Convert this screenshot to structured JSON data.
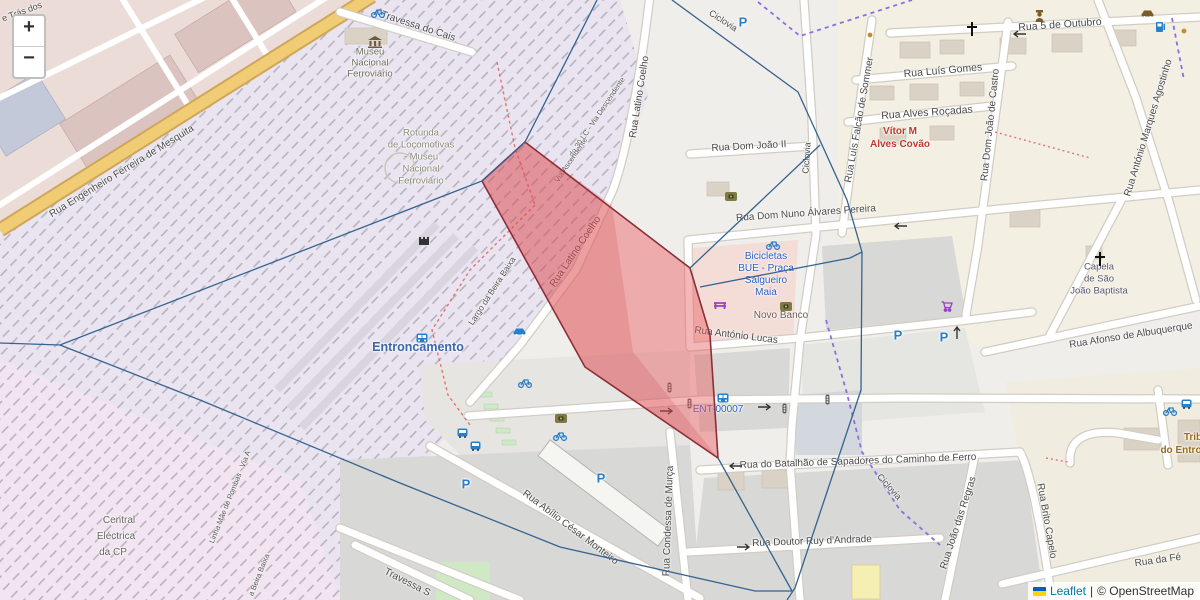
{
  "controls": {
    "zoom_in": "+",
    "zoom_out": "−"
  },
  "attribution": {
    "leaflet": "Leaflet",
    "separator": "|",
    "osm_credit": "© OpenStreetMap"
  },
  "labels": [
    {
      "name": "street-tras-dos",
      "text": "e Trás dos",
      "x": 22,
      "y": 12,
      "rot": -20,
      "size": 9,
      "color": "#4a4a4a"
    },
    {
      "name": "street-travessa-do-cais",
      "text": "Travessa do Cais",
      "x": 418,
      "y": 27,
      "rot": 18,
      "size": 10,
      "color": "#4a4a4a"
    },
    {
      "name": "poi-museu-1",
      "text": "Museu",
      "x": 370,
      "y": 52,
      "rot": 0,
      "size": 9.5,
      "color": "#6f6f5f"
    },
    {
      "name": "poi-museu-2",
      "text": "Nacional",
      "x": 370,
      "y": 63,
      "rot": 0,
      "size": 9.5,
      "color": "#6f6f5f"
    },
    {
      "name": "poi-museu-3",
      "text": "Ferroviário",
      "x": 370,
      "y": 74,
      "rot": 0,
      "size": 9.5,
      "color": "#6f6f5f"
    },
    {
      "name": "street-eng-mesquita",
      "text": "Rua Engenheiro Ferreira de Mesquita",
      "x": 122,
      "y": 172,
      "rot": -31.5,
      "size": 10,
      "color": "#4a4a4a"
    },
    {
      "name": "poi-rotunda-1",
      "text": "Rotunda",
      "x": 421,
      "y": 133,
      "rot": 0,
      "size": 9.5,
      "color": "#8b8b78"
    },
    {
      "name": "poi-rotunda-2",
      "text": "de Locomotivas",
      "x": 421,
      "y": 145,
      "rot": 0,
      "size": 9.5,
      "color": "#8b8b78"
    },
    {
      "name": "poi-rotunda-3",
      "text": "- Museu",
      "x": 421,
      "y": 157,
      "rot": 0,
      "size": 9.5,
      "color": "#8b8b78"
    },
    {
      "name": "poi-rotunda-4",
      "text": "Nacional",
      "x": 421,
      "y": 169,
      "rot": 0,
      "size": 9.5,
      "color": "#8b8b78"
    },
    {
      "name": "poi-rotunda-5",
      "text": "Ferroviário",
      "x": 421,
      "y": 181,
      "rot": 0,
      "size": 9.5,
      "color": "#8b8b78"
    },
    {
      "name": "street-latino-coelho-north",
      "text": "Rua Latino Coelho",
      "x": 640,
      "y": 97,
      "rot": -81,
      "size": 10,
      "color": "#4a4a4a"
    },
    {
      "name": "path-ciclovia-top",
      "text": "Ciclovia",
      "x": 723,
      "y": 21,
      "rot": 33,
      "size": 9,
      "color": "#4a4a4a"
    },
    {
      "name": "street-dom-joao-ii",
      "text": "Rua Dom João II",
      "x": 749,
      "y": 147,
      "rot": -3,
      "size": 10,
      "color": "#4a4a4a"
    },
    {
      "name": "path-ciclovia-vertical",
      "text": "Ciclovia",
      "x": 807,
      "y": 158,
      "rot": -86,
      "size": 9,
      "color": "#4a4a4a"
    },
    {
      "name": "street-5-outubro",
      "text": "Rua 5 de Outubro",
      "x": 1060,
      "y": 25,
      "rot": -4,
      "size": 10.5,
      "color": "#4a4a4a"
    },
    {
      "name": "street-luis-gomes",
      "text": "Rua Luís Gomes",
      "x": 943,
      "y": 71,
      "rot": -5,
      "size": 10.5,
      "color": "#4a4a4a"
    },
    {
      "name": "street-alves-rocadas",
      "text": "Rua Alves Roçadas",
      "x": 927,
      "y": 113,
      "rot": -4,
      "size": 10.5,
      "color": "#4a4a4a"
    },
    {
      "name": "poi-vitor-1",
      "text": "Vítor M",
      "x": 900,
      "y": 132,
      "rot": 0,
      "size": 10,
      "color": "#c0392b",
      "weight": 600
    },
    {
      "name": "poi-vitor-2",
      "text": "Alves Covão",
      "x": 900,
      "y": 145,
      "rot": 0,
      "size": 10,
      "color": "#c0392b",
      "weight": 600
    },
    {
      "name": "street-falcao-sommer",
      "text": "Rua Luís Falcão de Sommer",
      "x": 860,
      "y": 120,
      "rot": -80,
      "size": 10,
      "color": "#4a4a4a"
    },
    {
      "name": "street-dom-joao-castro",
      "text": "Rua Dom João de Castro",
      "x": 991,
      "y": 125,
      "rot": -84,
      "size": 10,
      "color": "#4a4a4a"
    },
    {
      "name": "street-marques-agostinho",
      "text": "Rua António Marques Agostinho",
      "x": 1149,
      "y": 128,
      "rot": -73,
      "size": 10,
      "color": "#4a4a4a"
    },
    {
      "name": "street-dom-nuno",
      "text": "Rua Dom Nuno Álvares Pereira",
      "x": 806,
      "y": 214,
      "rot": -4,
      "size": 10,
      "color": "#4a4a4a"
    },
    {
      "name": "poi-capela-1",
      "text": "Capela",
      "x": 1099,
      "y": 267,
      "rot": 0,
      "size": 9.5,
      "color": "#55556a"
    },
    {
      "name": "poi-capela-2",
      "text": "de São",
      "x": 1099,
      "y": 279,
      "rot": 0,
      "size": 9.5,
      "color": "#55556a"
    },
    {
      "name": "poi-capela-3",
      "text": "João Baptista",
      "x": 1099,
      "y": 291,
      "rot": 0,
      "size": 9.5,
      "color": "#55556a"
    },
    {
      "name": "street-afonso-albuquerque",
      "text": "Rua Afonso de Albuquerque",
      "x": 1131,
      "y": 336,
      "rot": -9,
      "size": 10,
      "color": "#4a4a4a"
    },
    {
      "name": "poi-bicicletas-1",
      "text": "Bicicletas",
      "x": 766,
      "y": 257,
      "rot": 0,
      "size": 10,
      "color": "#2e62c4"
    },
    {
      "name": "poi-bicicletas-2",
      "text": "BUE - Praça",
      "x": 766,
      "y": 269,
      "rot": 0,
      "size": 10,
      "color": "#2e62c4"
    },
    {
      "name": "poi-bicicletas-3",
      "text": "Salgueiro",
      "x": 766,
      "y": 281,
      "rot": 0,
      "size": 10,
      "color": "#2e62c4"
    },
    {
      "name": "poi-bicicletas-4",
      "text": "Maia",
      "x": 766,
      "y": 293,
      "rot": 0,
      "size": 10,
      "color": "#2e62c4"
    },
    {
      "name": "poi-novo-banco",
      "text": "Novo Banco",
      "x": 781,
      "y": 316,
      "rot": 0,
      "size": 10,
      "color": "#6d6154"
    },
    {
      "name": "street-antonio-lucas",
      "text": "Rua António Lucas",
      "x": 736,
      "y": 336,
      "rot": 7,
      "size": 10,
      "color": "#4a4a4a"
    },
    {
      "name": "station-entroncamento",
      "text": "Entroncamento",
      "x": 418,
      "y": 347,
      "rot": 0,
      "size": 12.5,
      "color": "#3a66ad",
      "weight": 700
    },
    {
      "name": "street-largo-beira-baixa",
      "text": "Largo da Beira Baixa",
      "x": 492,
      "y": 291,
      "rot": -57,
      "size": 8.5,
      "color": "#555555"
    },
    {
      "name": "rail-via-descendente",
      "text": "do 30 LC - Via Descendente",
      "x": 597,
      "y": 117,
      "rot": -56,
      "size": 7.5,
      "color": "#555555"
    },
    {
      "name": "rail-via-ascendente",
      "text": "Via Ascendente",
      "x": 571,
      "y": 160,
      "rot": -56,
      "size": 7.5,
      "color": "#555555"
    },
    {
      "name": "stop-ent-00007",
      "text": "ENT-00007",
      "x": 718,
      "y": 410,
      "rot": 0,
      "size": 10,
      "color": "#2e62c4"
    },
    {
      "name": "street-batalhao-sapadores",
      "text": "Rua do Batalhão de Sapadores do Caminho de Ferro",
      "x": 858,
      "y": 462,
      "rot": -2,
      "size": 10,
      "color": "#4a4a4a"
    },
    {
      "name": "path-ciclovia-se",
      "text": "Ciclovia",
      "x": 889,
      "y": 487,
      "rot": 48,
      "size": 9,
      "color": "#4a4a4a"
    },
    {
      "name": "street-ruy-andrade",
      "text": "Rua Doutor Ruy d'Andrade",
      "x": 812,
      "y": 542,
      "rot": -2,
      "size": 10,
      "color": "#4a4a4a"
    },
    {
      "name": "street-joao-regras",
      "text": "Rua João das Regras",
      "x": 959,
      "y": 523,
      "rot": -72,
      "size": 10,
      "color": "#4a4a4a"
    },
    {
      "name": "street-brito-capelo",
      "text": "Rua Brito Capelo",
      "x": 1046,
      "y": 521,
      "rot": 80,
      "size": 10,
      "color": "#4a4a4a"
    },
    {
      "name": "street-rua-da-fe",
      "text": "Rua da Fé",
      "x": 1158,
      "y": 561,
      "rot": -8,
      "size": 10,
      "color": "#4a4a4a"
    },
    {
      "name": "poi-tribunal-1",
      "text": "Trib",
      "x": 1193,
      "y": 438,
      "rot": 0,
      "size": 10,
      "color": "#9a6b1f",
      "weight": 600
    },
    {
      "name": "poi-tribunal-2",
      "text": "do Entro",
      "x": 1181,
      "y": 451,
      "rot": 0,
      "size": 10,
      "color": "#9a6b1f",
      "weight": 600
    },
    {
      "name": "poi-central-1",
      "text": "Central",
      "x": 119,
      "y": 521,
      "rot": 0,
      "size": 10,
      "color": "#686868"
    },
    {
      "name": "poi-central-2",
      "text": "Eléctrica",
      "x": 116,
      "y": 537,
      "rot": 0,
      "size": 10,
      "color": "#686868"
    },
    {
      "name": "poi-central-3",
      "text": "da CP",
      "x": 113,
      "y": 553,
      "rot": 0,
      "size": 10,
      "color": "#686868"
    },
    {
      "name": "rail-linha-mae",
      "text": "Linha Mãe de Pombas - Via A",
      "x": 230,
      "y": 497,
      "rot": -68,
      "size": 7.5,
      "color": "#555555"
    },
    {
      "name": "rail-beira-baixa",
      "text": "a Beira Baixa",
      "x": 259,
      "y": 575,
      "rot": -68,
      "size": 7.5,
      "color": "#555555"
    },
    {
      "name": "street-abilio-monteiro",
      "text": "Rua Abílio César Monteiro",
      "x": 570,
      "y": 528,
      "rot": 37,
      "size": 10,
      "color": "#4a4a4a"
    },
    {
      "name": "street-condessa-murca",
      "text": "Rua Condessa de Murça",
      "x": 669,
      "y": 521,
      "rot": -88,
      "size": 10,
      "color": "#4a4a4a"
    },
    {
      "name": "street-travessa-s",
      "text": "Travessa S",
      "x": 407,
      "y": 583,
      "rot": 27,
      "size": 10,
      "color": "#4a4a4a"
    },
    {
      "name": "street-latino-coelho-red",
      "text": "Rua Latino Coelho",
      "x": 576,
      "y": 252,
      "rot": -56,
      "size": 10,
      "color": "#4a4a4a"
    },
    {
      "name": "parking-label",
      "text": "P",
      "x": 743,
      "y": 22,
      "rot": 0,
      "size": 13,
      "color": "#2a7fc9",
      "weight": 700
    },
    {
      "name": "parking-label",
      "text": "P",
      "x": 898,
      "y": 335,
      "rot": 0,
      "size": 13,
      "color": "#2a7fc9",
      "weight": 700
    },
    {
      "name": "parking-label",
      "text": "P",
      "x": 944,
      "y": 337,
      "rot": 0,
      "size": 13,
      "color": "#2a7fc9",
      "weight": 700
    },
    {
      "name": "parking-label",
      "text": "P",
      "x": 466,
      "y": 484,
      "rot": 0,
      "size": 13,
      "color": "#2a7fc9",
      "weight": 700
    },
    {
      "name": "parking-label",
      "text": "P",
      "x": 601,
      "y": 478,
      "rot": 0,
      "size": 13,
      "color": "#2a7fc9",
      "weight": 700
    }
  ],
  "icons": [
    {
      "type": "museum-icon",
      "x": 368,
      "y": 36
    },
    {
      "type": "bicycle-icon",
      "x": 371,
      "y": 8
    },
    {
      "type": "church-cross-icon",
      "x": 966,
      "y": 22
    },
    {
      "type": "church-cross-icon",
      "x": 1094,
      "y": 252
    },
    {
      "type": "police-icon",
      "x": 1034,
      "y": 10
    },
    {
      "type": "car-icon-brown",
      "x": 1141,
      "y": 9
    },
    {
      "type": "fuel-icon",
      "x": 1155,
      "y": 21
    },
    {
      "type": "bank-icon",
      "x": 725,
      "y": 192
    },
    {
      "type": "bank-icon",
      "x": 780,
      "y": 302
    },
    {
      "type": "bank-icon",
      "x": 555,
      "y": 414
    },
    {
      "type": "bench-icon",
      "x": 713,
      "y": 300
    },
    {
      "type": "cart-icon",
      "x": 941,
      "y": 301
    },
    {
      "type": "car-icon-blue",
      "x": 513,
      "y": 327
    },
    {
      "type": "transit-icon",
      "x": 416,
      "y": 333
    },
    {
      "type": "transit-icon",
      "x": 717,
      "y": 393
    },
    {
      "type": "bus-icon",
      "x": 457,
      "y": 428
    },
    {
      "type": "bus-icon",
      "x": 470,
      "y": 441
    },
    {
      "type": "bus-icon",
      "x": 1181,
      "y": 399
    },
    {
      "type": "bicycle-icon",
      "x": 518,
      "y": 378
    },
    {
      "type": "bicycle-icon",
      "x": 553,
      "y": 431
    },
    {
      "type": "bicycle-icon",
      "x": 766,
      "y": 240
    },
    {
      "type": "bicycle-icon",
      "x": 1163,
      "y": 406
    },
    {
      "type": "tower-icon",
      "x": 418,
      "y": 234
    },
    {
      "type": "traffic-light-icon",
      "x": 667,
      "y": 382
    },
    {
      "type": "traffic-light-icon",
      "x": 687,
      "y": 398
    },
    {
      "type": "traffic-light-icon",
      "x": 782,
      "y": 403
    },
    {
      "type": "traffic-light-icon",
      "x": 825,
      "y": 394
    },
    {
      "type": "arrow-left-icon",
      "x": 1012,
      "y": 30
    },
    {
      "type": "arrow-left-icon",
      "x": 893,
      "y": 222
    },
    {
      "type": "arrow-right-icon",
      "x": 660,
      "y": 407
    },
    {
      "type": "arrow-right-icon",
      "x": 758,
      "y": 403
    },
    {
      "type": "arrow-left-icon",
      "x": 728,
      "y": 462
    },
    {
      "type": "arrow-right-icon",
      "x": 737,
      "y": 543
    },
    {
      "type": "arrow-up-icon",
      "x": 953,
      "y": 325
    },
    {
      "type": "dot-icon",
      "x": 867,
      "y": 32
    },
    {
      "type": "dot-icon",
      "x": 1181,
      "y": 28
    }
  ],
  "overlays": {
    "edge_color": "#35638f",
    "edges": [
      [
        [
          0,
          343
        ],
        [
          60,
          345
        ],
        [
          482,
          181
        ],
        [
          525,
          142
        ]
      ],
      [
        [
          597,
          0
        ],
        [
          525,
          142
        ]
      ],
      [
        [
          672,
          0
        ],
        [
          798,
          92
        ],
        [
          847,
          200
        ],
        [
          862,
          252
        ]
      ],
      [
        [
          690,
          268
        ],
        [
          820,
          145
        ]
      ],
      [
        [
          700,
          287
        ],
        [
          850,
          258
        ],
        [
          862,
          252
        ]
      ],
      [
        [
          862,
          252
        ],
        [
          861,
          390
        ],
        [
          795,
          588
        ],
        [
          787,
          600
        ]
      ],
      [
        [
          60,
          345
        ],
        [
          200,
          400
        ],
        [
          400,
          483
        ],
        [
          560,
          547
        ],
        [
          755,
          591
        ],
        [
          792,
          591
        ]
      ],
      [
        [
          718,
          458
        ],
        [
          792,
          591
        ]
      ]
    ],
    "highlight": {
      "stroke": "#8a2f38",
      "fill": "rgba(232,88,92,0.44)",
      "points": [
        [
          525,
          142
        ],
        [
          690,
          268
        ],
        [
          710,
          335
        ],
        [
          718,
          458
        ],
        [
          585,
          367
        ],
        [
          482,
          181
        ]
      ],
      "overlay_fill": "rgba(190,40,50,0.16)",
      "overlay_points": [
        [
          525,
          142
        ],
        [
          612,
          205
        ],
        [
          633,
          352
        ],
        [
          718,
          458
        ],
        [
          585,
          367
        ],
        [
          482,
          181
        ]
      ]
    }
  }
}
